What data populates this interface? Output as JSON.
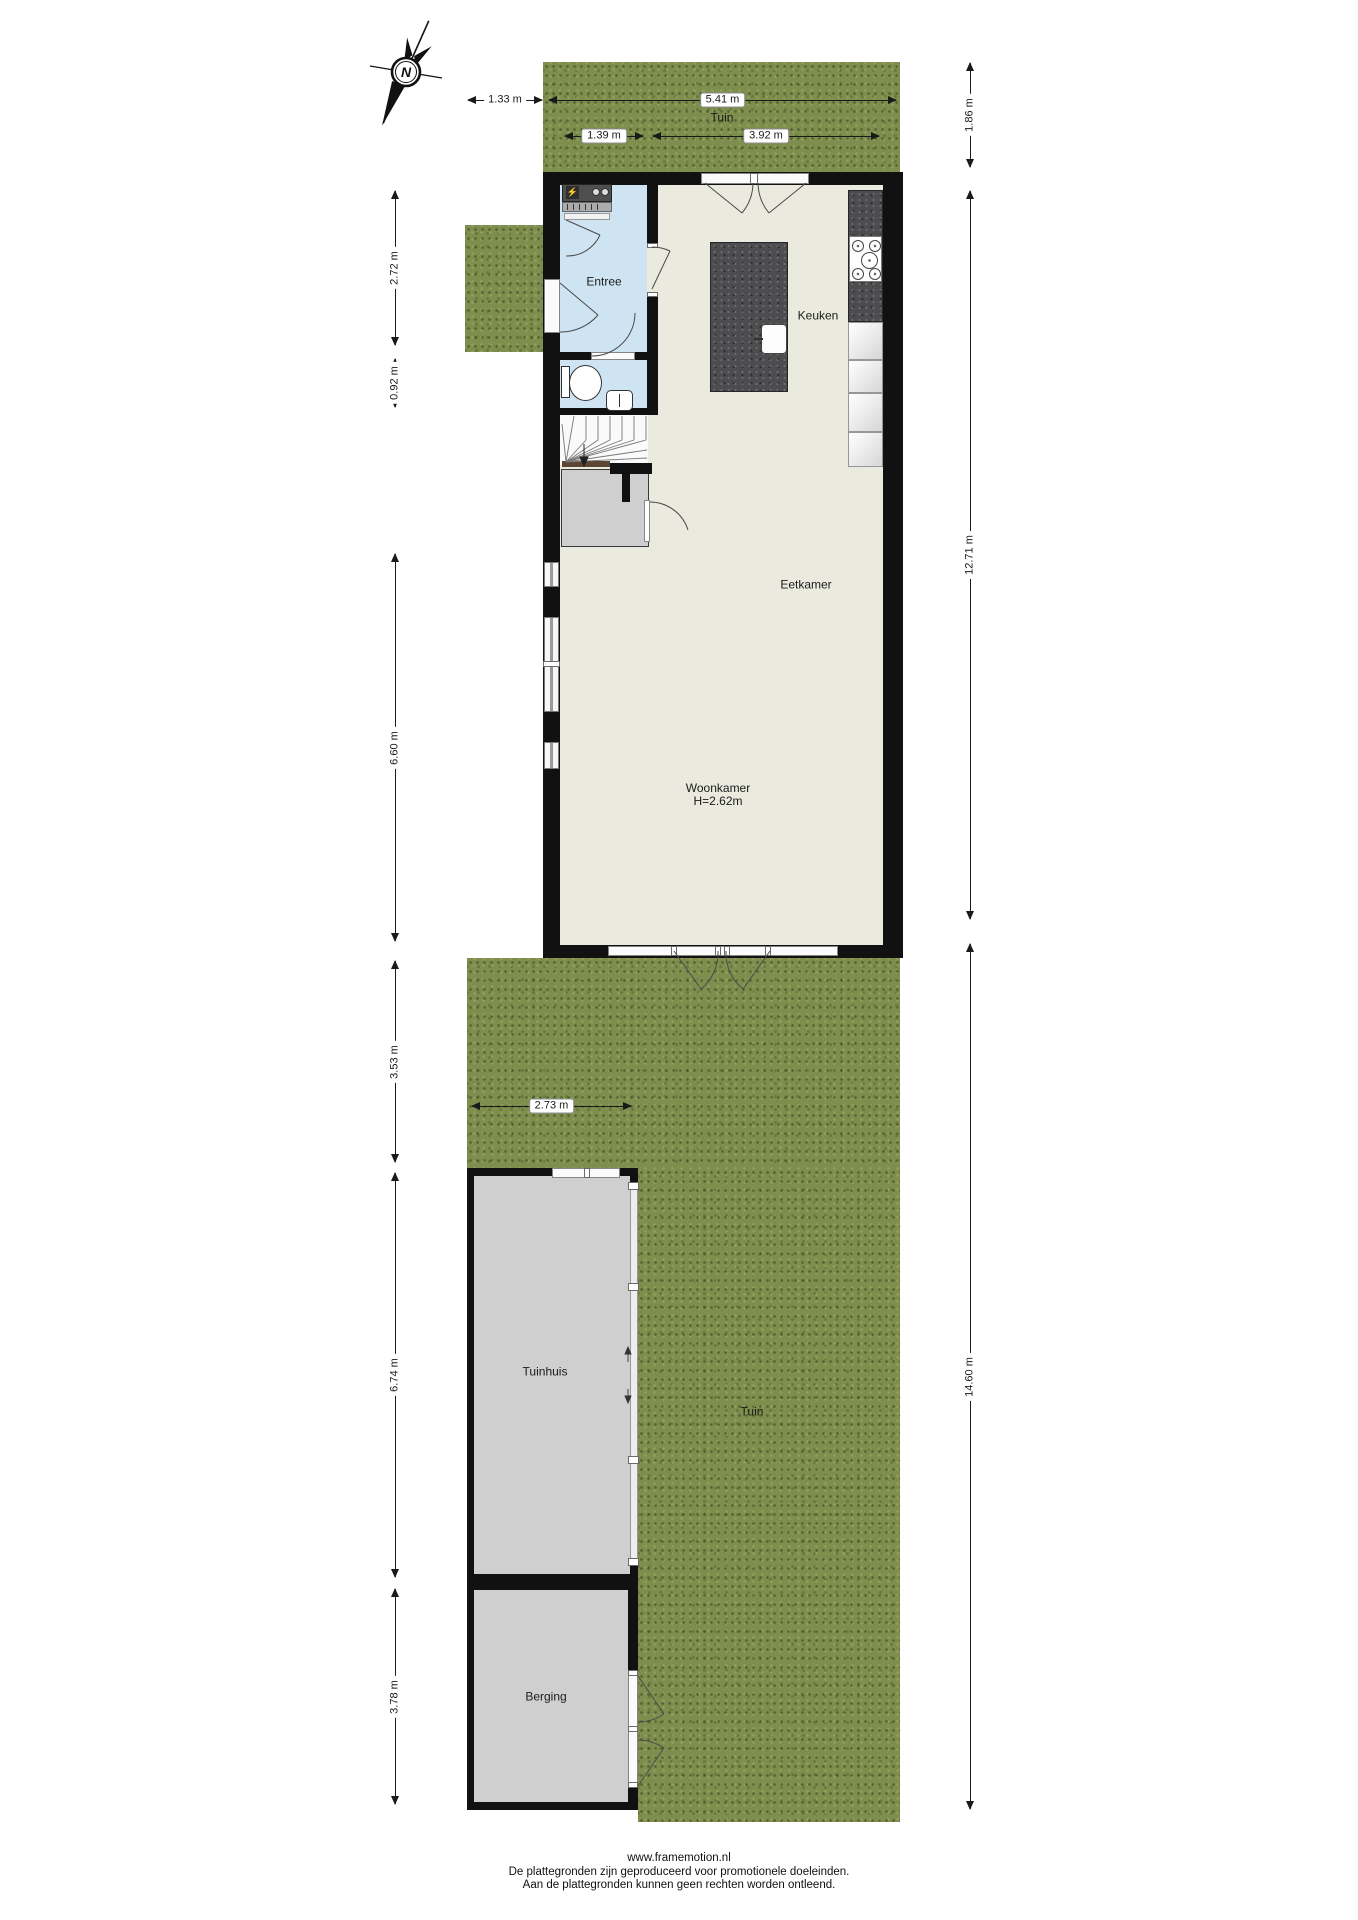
{
  "compass": {
    "north_label": "N"
  },
  "rooms": {
    "entree": "Entree",
    "keuken": "Keuken",
    "eetkamer": "Eetkamer",
    "woonkamer": "Woonkamer",
    "woonkamer_ceiling_height": "H=2.62m",
    "tuin_top": "Tuin",
    "tuin_bottom": "Tuin",
    "tuinhuis": "Tuinhuis",
    "berging": "Berging"
  },
  "dimensions": {
    "outside_left_width": "1.33 m",
    "house_total_width": "5.41 m",
    "entree_width": "1.39 m",
    "keuken_width": "3.92 m",
    "garden_top_depth": "1.86 m",
    "house_total_depth": "12.71 m",
    "garden_bottom_depth": "14.60 m",
    "entree_depth": "2.72 m",
    "toilet_depth": "0.92 m",
    "woonkamer_depth": "6.60 m",
    "garden_to_tuinhuis_depth": "3.53 m",
    "tuinhuis_width": "2.73 m",
    "tuinhuis_depth": "6.74 m",
    "berging_depth": "3.78 m"
  },
  "footer": {
    "url": "www.framemotion.nl",
    "disclaimer1": "De plattegronden zijn geproduceerd voor promotionele doeleinden.",
    "disclaimer2": "Aan de plattegronden kunnen geen rechten worden ontleend."
  },
  "colors": {
    "grass": "#7e8e4f",
    "floor": "#eaeadf",
    "wet_room_floor": "#cfe4f3",
    "wall": "#111111",
    "outbuilding_floor": "#cfcfcf",
    "counter_dark": "#4d4d4f",
    "fuse_bolt_yellow": "#ffe000"
  }
}
